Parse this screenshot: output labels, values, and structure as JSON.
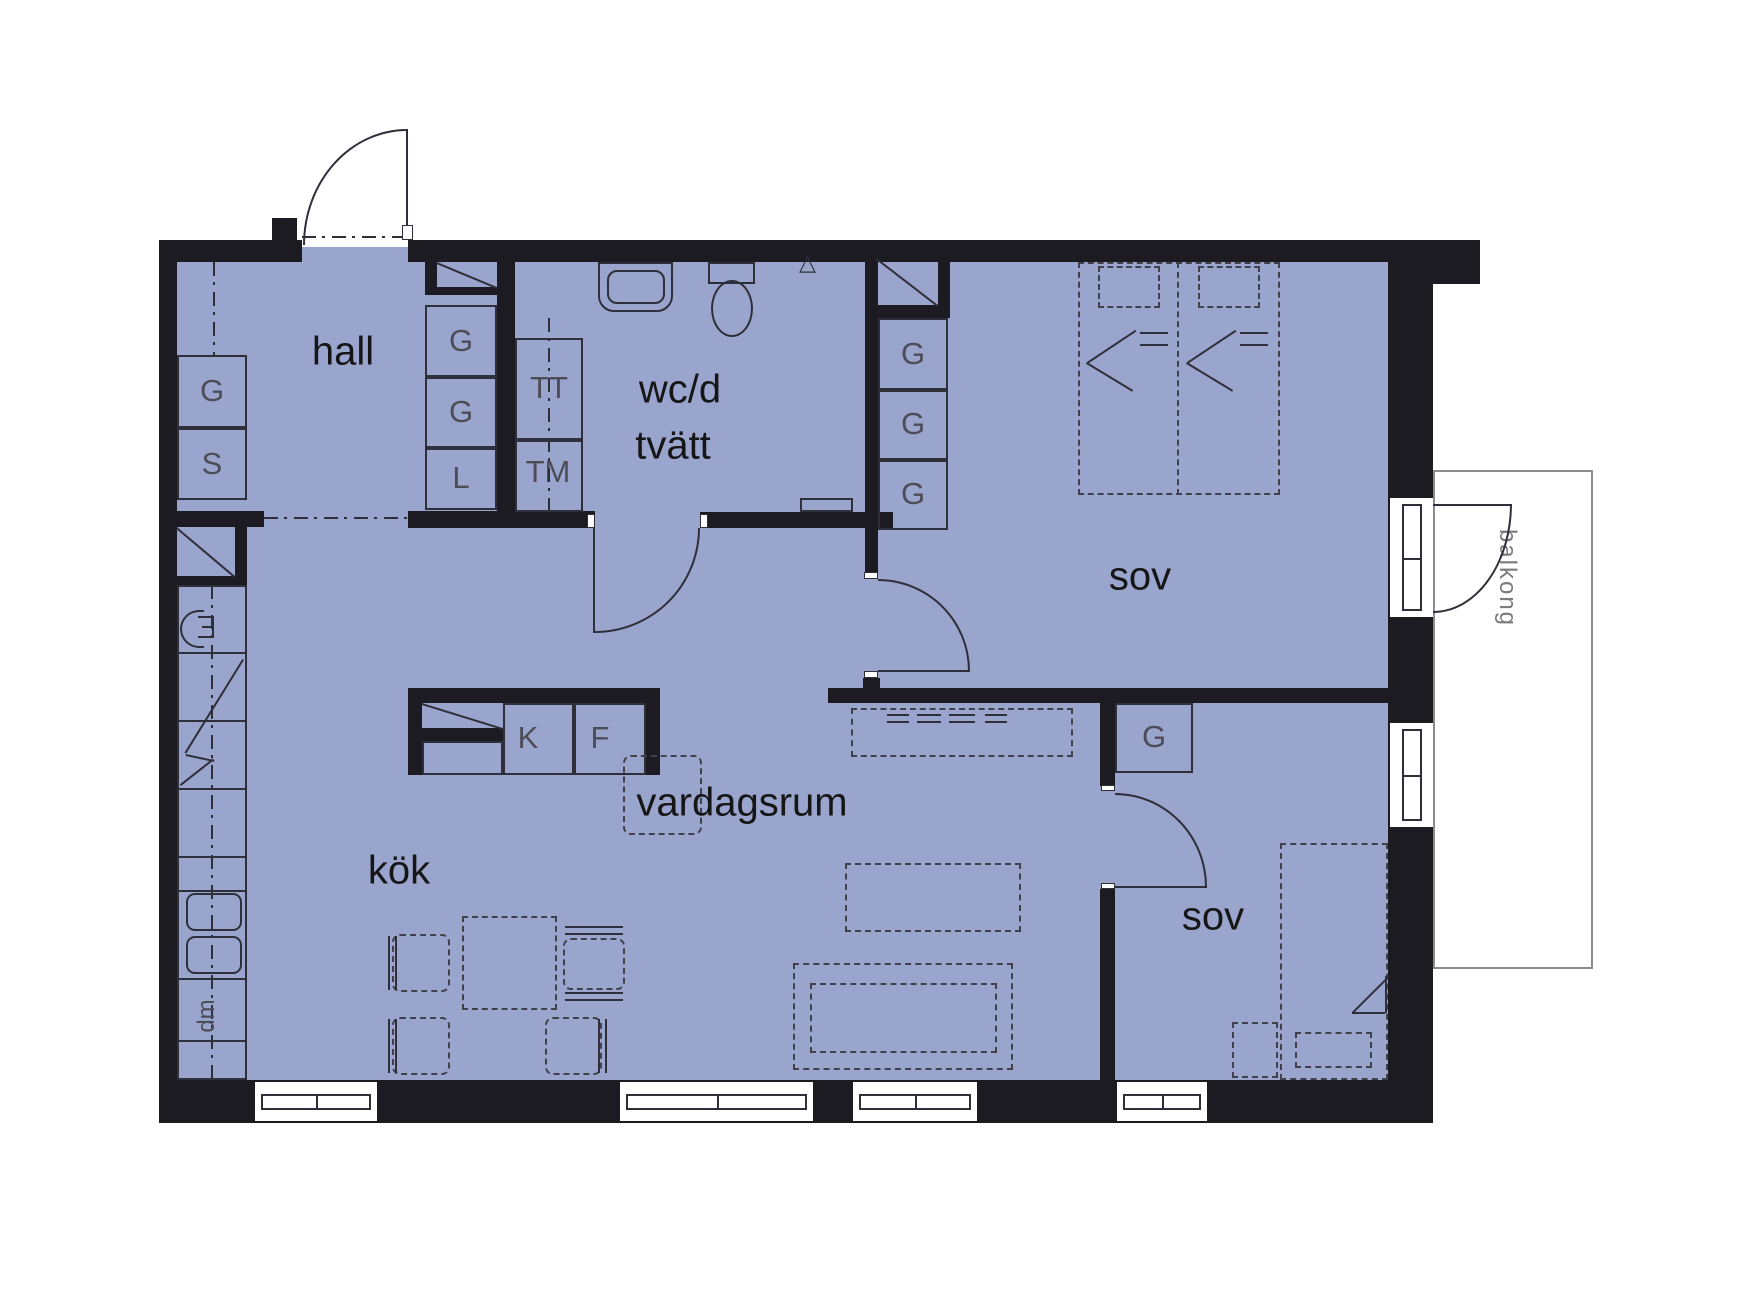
{
  "title": "apartment floor plan",
  "rooms": {
    "hall": "hall",
    "wc_line1": "wc/d",
    "wc_line2": "tvätt",
    "kitchen": "kök",
    "living": "vardagsrum",
    "bedroom1": "sov",
    "bedroom2": "sov",
    "balcony": "balkong"
  },
  "cabinets": {
    "wardrobe": "G",
    "cleaning": "S",
    "linen": "L"
  },
  "appliances": {
    "fridge": "K",
    "freezer": "F",
    "dryer": "TT",
    "washer": "TM",
    "dishwasher": "dm"
  },
  "icons": {
    "shower_triangle": "△"
  },
  "colors": {
    "floor": "#9aa5ce",
    "wall": "#1b1b21",
    "line": "#2f2f3a",
    "dash": "#41414b",
    "room_label": "#161616",
    "cabinet_label": "#4d4d58",
    "balcony_line": "#8c8c8c",
    "balcony_label": "#7b7b7b",
    "background": "#ffffff"
  }
}
